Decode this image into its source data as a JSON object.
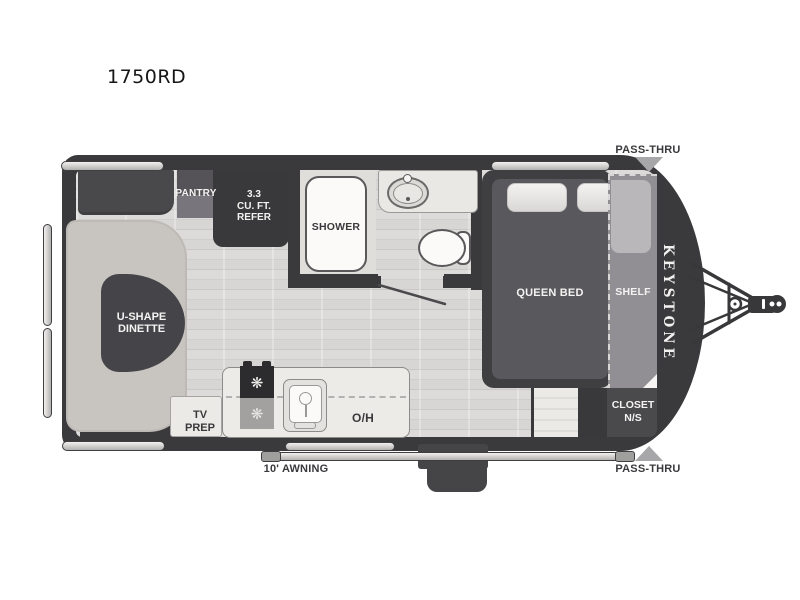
{
  "title": "1750RD",
  "brand": "KEYSTONE",
  "colors": {
    "wall": "#3a393c",
    "floor": "#d8d7d5",
    "bench": "#c8c5c0",
    "counter": "#edebe7",
    "bed": "#59585c",
    "arrow": "#a7a6a8"
  },
  "rooms": {
    "pantry": {
      "label": "PANTRY"
    },
    "refer": {
      "line1": "3.3",
      "line2": "CU. FT.",
      "line3": "REFER"
    },
    "shower": {
      "label": "SHOWER"
    },
    "dinette": {
      "line1": "U-SHAPE",
      "line2": "DINETTE"
    },
    "queen_bed": {
      "label": "QUEEN BED"
    },
    "shelf": {
      "label": "SHELF"
    },
    "closet": {
      "line1": "CLOSET",
      "line2": "N/S"
    },
    "tv_prep": {
      "line1": "TV",
      "line2": "PREP"
    },
    "overhead": {
      "label": "O/H"
    }
  },
  "exterior": {
    "awning_label": "10' AWNING",
    "pass_thru_top": "PASS-THRU",
    "pass_thru_bottom": "PASS-THRU"
  }
}
